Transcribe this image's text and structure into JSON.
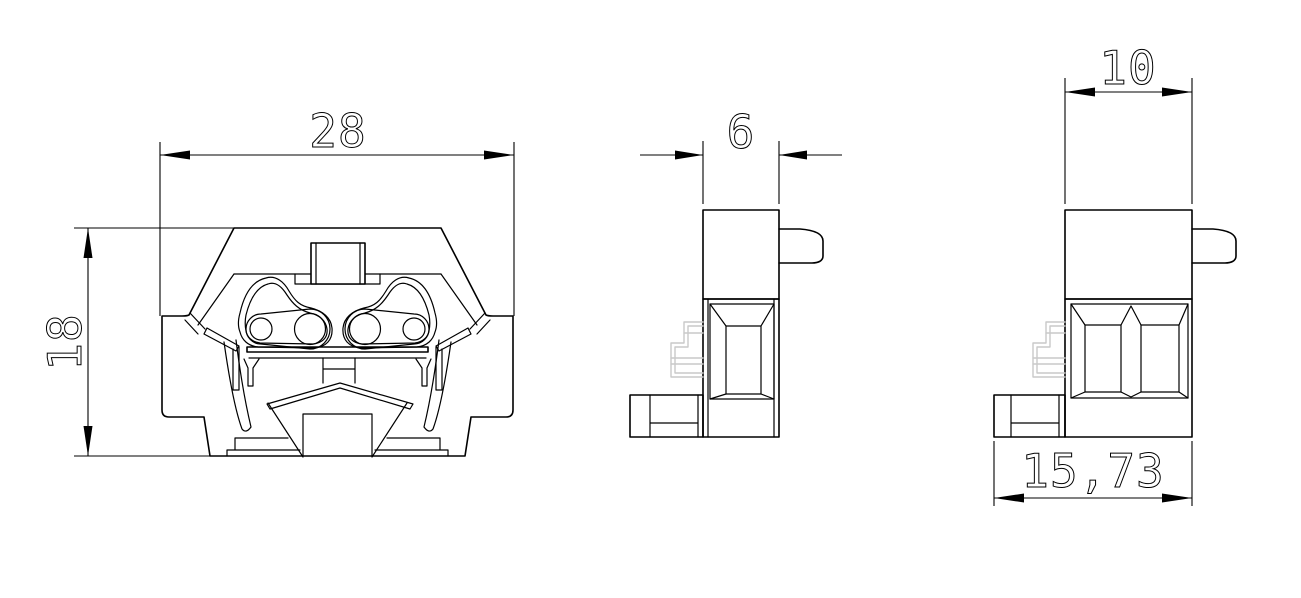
{
  "drawing": {
    "kind": "engineering-orthographic-views",
    "subject": "terminal-block",
    "background_color": "#ffffff",
    "line_color": "#000000",
    "phantom_line_color": "#c9c9c9",
    "dimensions": {
      "front_width": {
        "label": "28"
      },
      "front_height": {
        "label": "18"
      },
      "side_depth": {
        "label": "6"
      },
      "end_width": {
        "label": "10"
      },
      "end_base_width": {
        "label": "15,73"
      }
    }
  }
}
